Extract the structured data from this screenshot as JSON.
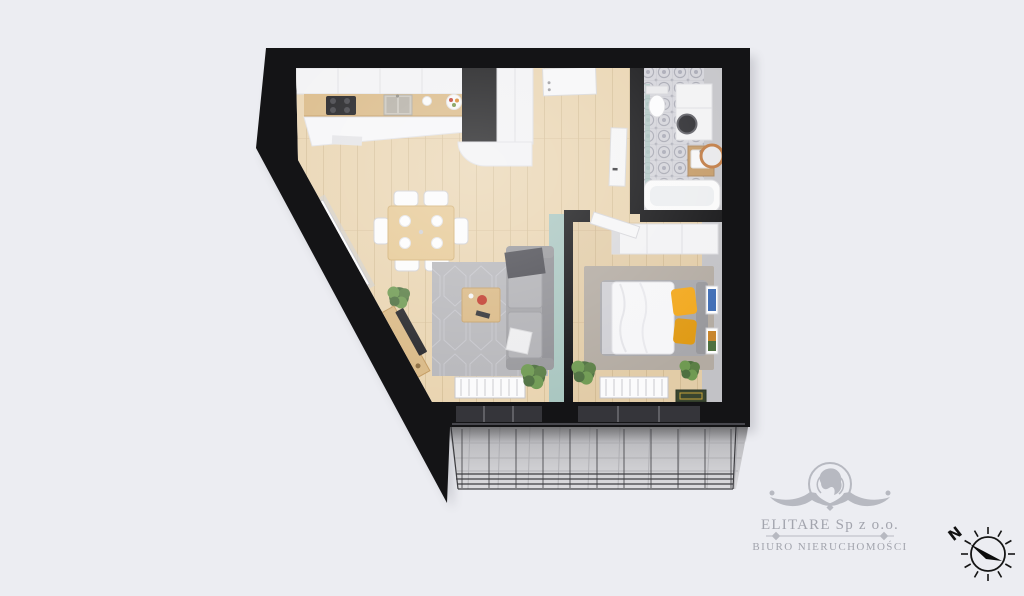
{
  "branding": {
    "company": "ELITARE Sp z o.o.",
    "tagline": "BIURO NIERUCHOMOŚCI"
  },
  "compass": {
    "north_label": "N"
  },
  "colors": {
    "background": "#ecedf2",
    "wall": "#141416",
    "floor_wood": "#e9d4b0",
    "floor_wood_line": "#d5bd95",
    "counter_wood": "#d9b884",
    "cabinet_white": "#f2f2f4",
    "rug_gray": "#b6b6ba",
    "rug_bedroom": "#b3aba2",
    "sofa_gray": "#a2a2a6",
    "sofa_dark": "#4b4b52",
    "teal_wall": "#a9c6c0",
    "yellow_accent": "#f2a81d",
    "tile_base": "#d4d4da",
    "tile_motif": "#9fa0ac",
    "concrete": "#c7c7ca",
    "plant_dark": "#4e7040",
    "plant_mid": "#5b7f46",
    "plant_light": "#6f9a52",
    "copper": "#c07b43",
    "logo_gray": "#b7b9c1",
    "logo_text": "#a2a4ad",
    "glass_dark": "#35353a"
  }
}
